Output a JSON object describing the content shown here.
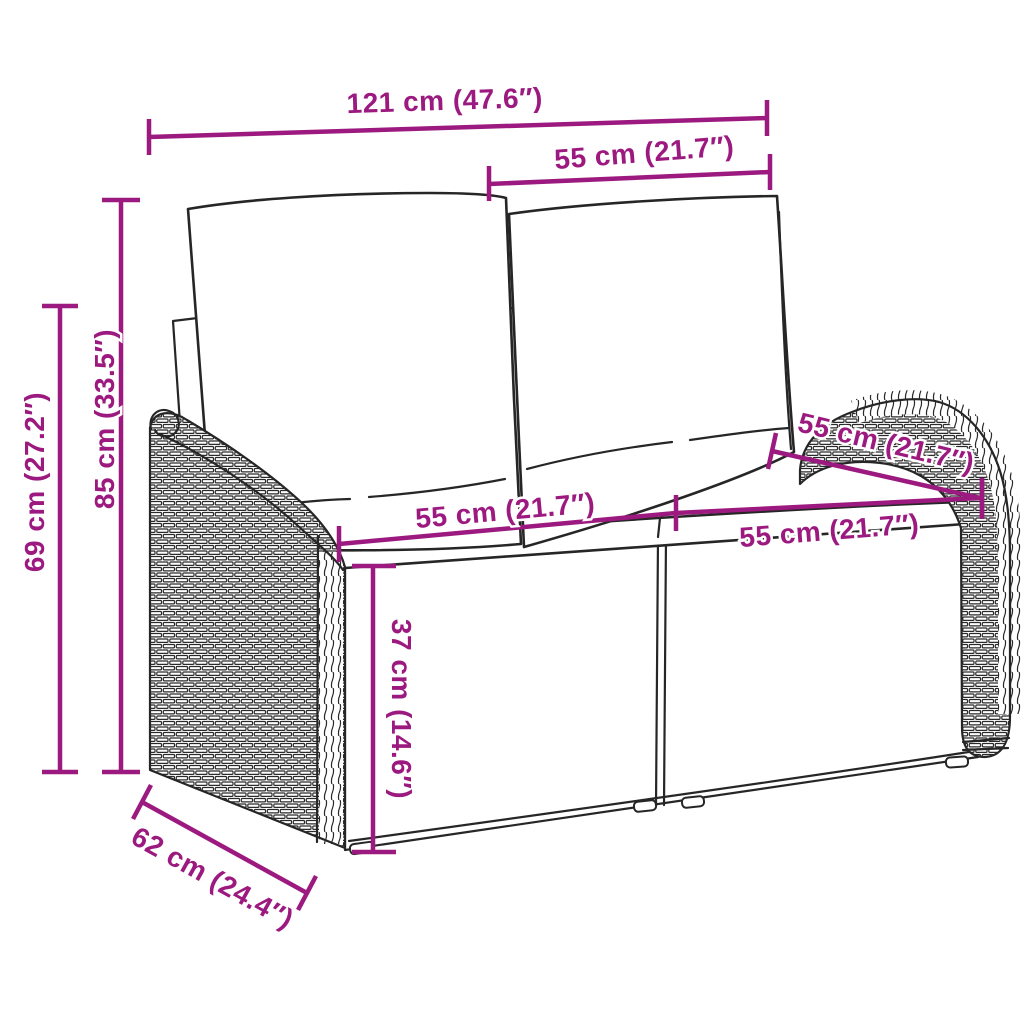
{
  "figure": {
    "type": "product dimension diagram",
    "description": "line drawing of a two-seater poly rattan garden bench with back and seat cushions, annotated with measurements"
  },
  "colors": {
    "background": "#ffffff",
    "line_art": "#262626",
    "dimension_accent": "#9C1A80"
  },
  "dimensions": {
    "width_total": "121 cm (47.6″)",
    "width_backrest": "55 cm (21.7″)",
    "height_total": "85 cm (33.5″)",
    "height_armrest": "69 cm (27.2″)",
    "depth_total": "62 cm (24.4″)",
    "depth_seat": "55 cm (21.7″)",
    "width_seat_left": "55 cm (21.7″)",
    "width_seat_right": "55 cm (21.7″)",
    "height_seat": "37 cm (14.6″)"
  }
}
